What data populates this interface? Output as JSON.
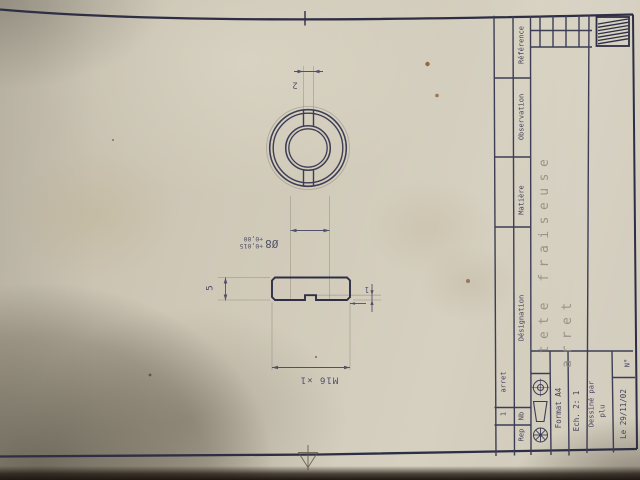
{
  "colors": {
    "paper": "#d0c9b8",
    "ink": "#3d3d55",
    "ink2": "#2e2e44",
    "pencil": "#8d8578",
    "dimc": "#50506a",
    "bigtext": "#8f897e",
    "tabledark": "#1f1710"
  },
  "views": {
    "dimensions": {
      "slot_width": "2",
      "bore": "Ø8",
      "bore_tol_upper": "+0,015",
      "bore_tol_lower": "+0,00",
      "thickness": "5",
      "thread": "M16 ×1",
      "slot_depth": "1"
    }
  },
  "title_block": {
    "item_row": {
      "nb": "1",
      "designation": "arret"
    },
    "headers": {
      "rep": "Rep",
      "nb": "Nb",
      "designation": "Désignation",
      "matiere": "Matière",
      "observation": "Observation",
      "reference": "Référence"
    },
    "title_line1": "tete fraiseuse",
    "title_line2": "arret",
    "format": "Format A4",
    "scale": "Ech. 2: 1",
    "drawn_by_label": "Dessiné par",
    "drawn_by": "plu",
    "date": "Le 29/11/02",
    "number": "N°",
    "icons": [
      "projection-target-icon",
      "cone-frustum-icon",
      "gear-icon",
      "hatched-logo-icon"
    ]
  }
}
